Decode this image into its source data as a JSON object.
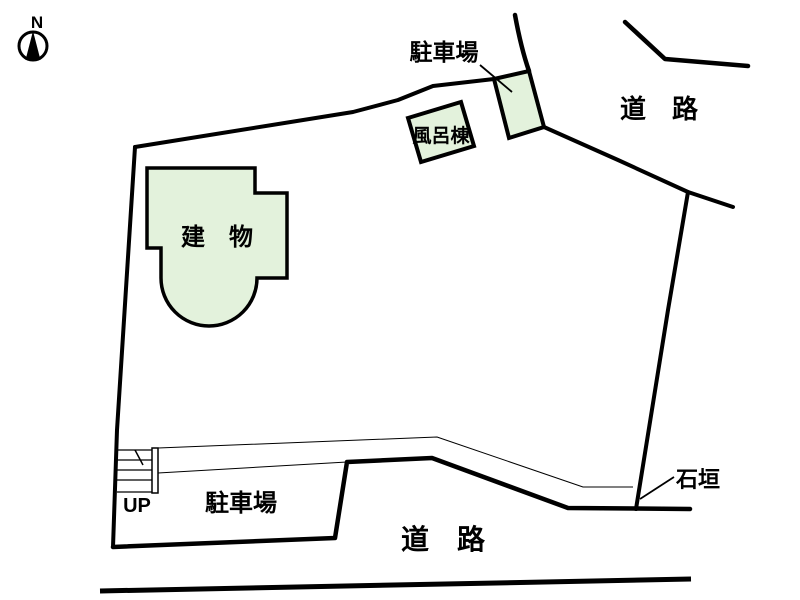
{
  "compass": {
    "north_label": "N"
  },
  "labels": {
    "parking_top": "駐車場",
    "road_top": "道　路",
    "bath_building": "風呂棟",
    "main_building": "建　物",
    "stairs_up": "UP",
    "parking_bottom": "駐車場",
    "road_bottom": "道　路",
    "stone_wall": "石垣"
  },
  "colors": {
    "line": "#000000",
    "area_fill": "#e3f2dc",
    "background": "#ffffff"
  }
}
